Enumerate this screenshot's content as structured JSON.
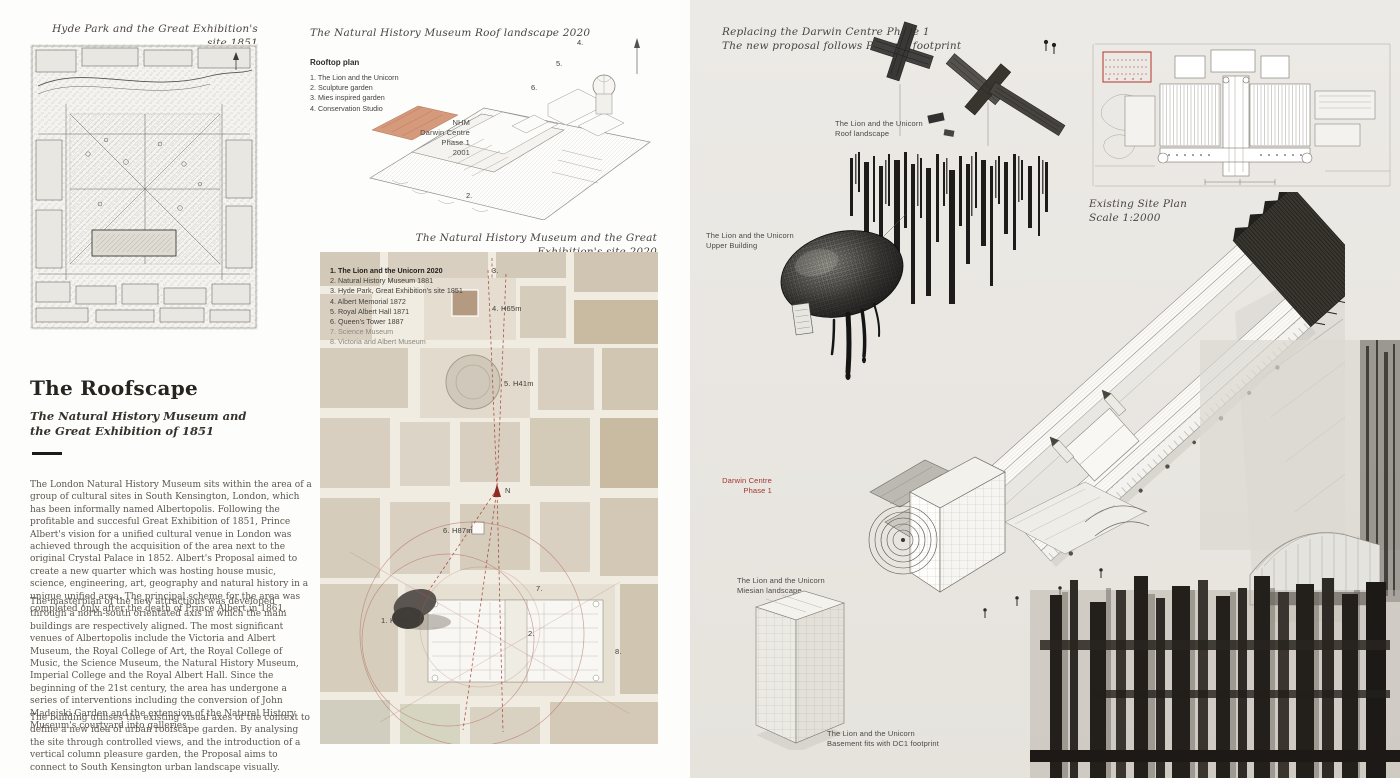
{
  "left": {
    "map_caption": "Hyde Park and the Great Exhibition's site 1851",
    "heading": "The Roofscape",
    "subheading": "The Natural History Museum and the Great Exhibition of 1851",
    "paragraphs": [
      "The London Natural History Museum sits within the area of a group of cultural sites in South Kensington, London, which has been informally named Albertopolis.  Following the profitable and succesful Great Exhibition of 1851, Prince Albert's vision for a unified cultural venue in London was achieved through the acquisition of the area next to the original Crystal Palace in 1852. Albert's Proposal aimed to create a new quarter which was hosting house music, science, engineering, art, geography and natural history in a unique unified area. The principal scheme for the area was completed only after the death of Prince Albert in 1861.",
      "The masterplan of the new attractions was developed through a north-south orientated axis in which the main buildings are respectively aligned. The most significant venues of Albertopolis include the Victoria and Albert Museum, the Royal College of Art, the Royal College of Music, the Science Museum, the Natural History Museum, Imperial College and the Royal Albert Hall. Since the beginning of the 21st century, the area has undergone a series of interventions including the conversion of John Madejski Garden and the extension of the Natural History Museum's courtyard into galleries.",
      "The building utilises the existing visual axes of the context to define a new idea of urban roofscape garden. By analysing the site through controlled views, and the introduction of a vertical column pleasure garden, the Proposal aims to connect to South Kensington urban landscape visually."
    ]
  },
  "middle": {
    "axo_caption": "The Natural History Museum Roof landscape 2020",
    "rooftop": {
      "title": "Rooftop plan",
      "items": [
        "1. The Lion and the Unicorn",
        "2. Sculpture garden",
        "3. Mies inspired garden",
        "4. Conservation Studio"
      ]
    },
    "nhm_label": [
      "NHM",
      "Darwin Centre",
      "Phase 1",
      "2001"
    ],
    "axo_numbers": {
      "n4": "4.",
      "n5": "5.",
      "n6": "6.",
      "n2": "2."
    },
    "map_caption": "The Natural History Museum and the Great Exhibition's site 2020",
    "map_legend": {
      "items": [
        "1. The Lion and the Unicorn 2020",
        "2. Natural History Museum 1881",
        "3. Hyde Park, Great Exhibition's site 1851",
        "4. Albert Memorial 1872",
        "5. Royal Albert Hall 1871",
        "6. Queen's Tower 1887",
        "7. Science Museum",
        "8. Victoria and Albert Museum"
      ]
    },
    "map_labels": {
      "m3": "3.",
      "m4": "4. H65m",
      "m5": "5. H41m",
      "m6": "6. H87m",
      "m7": "7.",
      "m1": "1. H65m",
      "m2": "2.",
      "m8": "8.",
      "north": "N"
    }
  },
  "right": {
    "caption": [
      "Replacing the Darwin Centre Phase 1",
      "The new proposal follows Phase 1 footprint"
    ],
    "labels": {
      "roof": [
        "The Lion and the Unicorn",
        "Roof landscape"
      ],
      "upper": [
        "The Lion and the Unicorn",
        "Upper Building"
      ],
      "site_plan": [
        "Existing Site Plan",
        "Scale 1:2000"
      ],
      "darwin": [
        "Darwin Centre",
        "Phase 1"
      ],
      "miesian": [
        "The Lion and the Unicorn",
        "Miesian landscape"
      ],
      "basement": [
        "The Lion and the Unicorn",
        "Basement fits with DC1 footprint"
      ]
    }
  },
  "colors": {
    "accent_red": "#a6342b",
    "map_dashed_red": "#a23a2e",
    "salmon_highlight": "#d5997b",
    "map_base": "#f0ece2",
    "map_block": "#d7cebf",
    "right_panel_bg": "#e9e6e1",
    "ink": "#2e2b27"
  }
}
